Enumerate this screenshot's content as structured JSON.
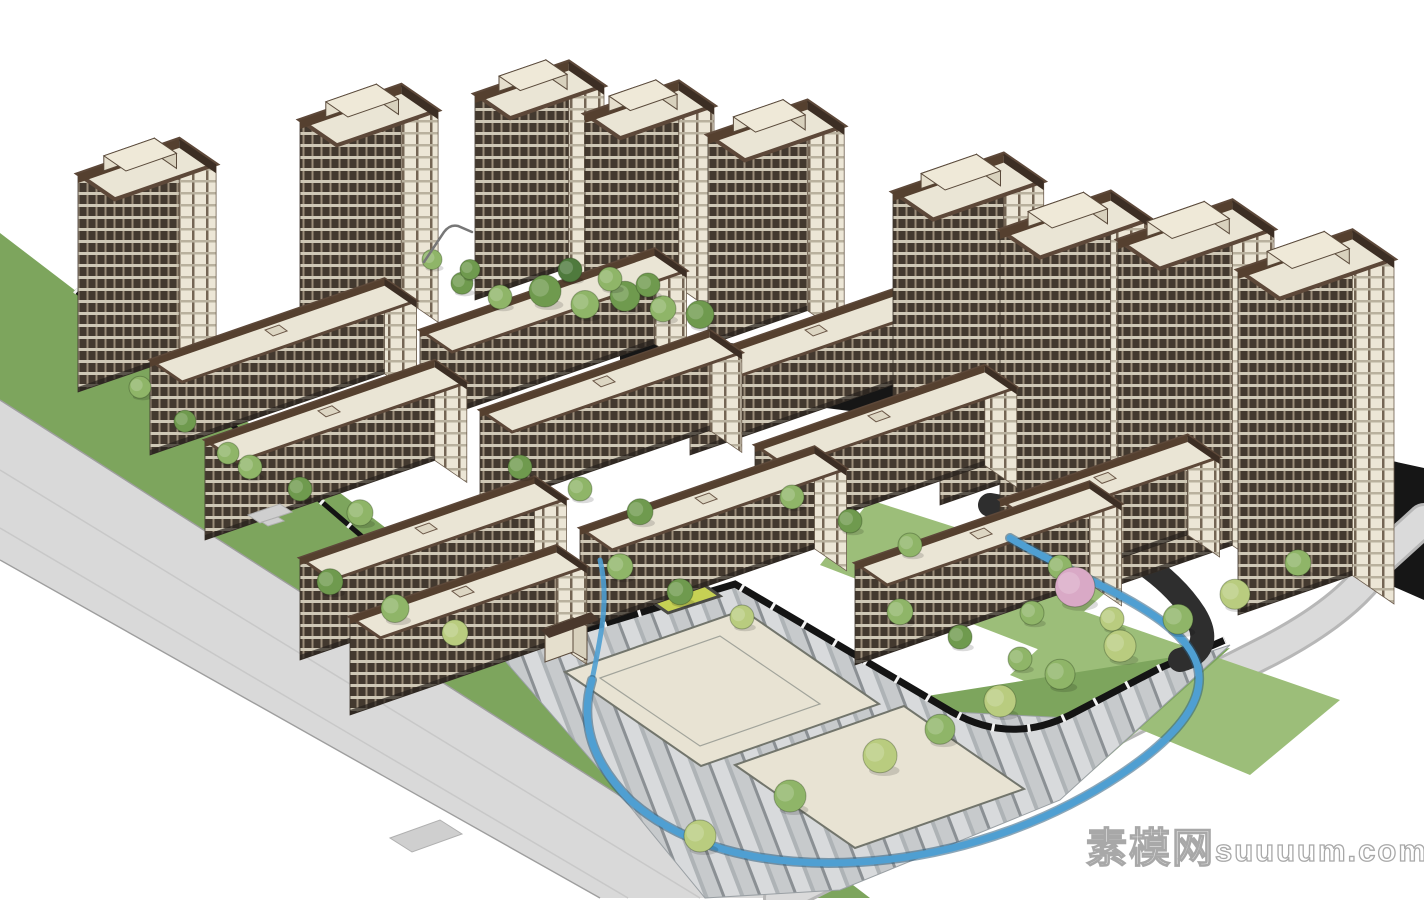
{
  "meta": {
    "image_type": "3d-architectural-massing-rendering",
    "subject": "residential-complex-site-aerial-view"
  },
  "watermark": {
    "cjk": "素模网",
    "latin": "suuuum.com"
  },
  "palette": {
    "bg": "#ffffff",
    "lawn": "#7da55d",
    "lawnLight": "#9cbe79",
    "gardenGreen": "#c6d154",
    "road": "#d9d9d9",
    "roadEdge": "#9e9e9e",
    "laneLine": "#c8c8c8",
    "sidewalk": "#dadada",
    "sidewalkEdge": "#b7b7b7",
    "asphalt": "#2e2e2e",
    "backRoad": "#161616",
    "paveA": "#c7cacc",
    "paveB": "#d8dadc",
    "paveDark": "#8b9094",
    "paveMid": "#aeb3b6",
    "pad": "#e8e3d3",
    "padLine": "#72756c",
    "padSmall": "#cfcfcf",
    "water": "#4f9fd2",
    "waterDark": "#2c5d7e",
    "fence": "#141414",
    "post": "#f2f2f2",
    "cream": "#eae5d5",
    "creamSide": "#ece6d6",
    "winDark": "#43392f",
    "winLight": "#9b8d7a",
    "band": "#cfc8b6",
    "sideLine": "#b9b19e",
    "sideWin": "#746554",
    "roofEdge": "#5d4839",
    "towerCap": "#55402f",
    "capSide": "#3c2e24",
    "roofBox": "#e5dfcd",
    "roofBoxSide": "#d8d1bd",
    "roofBoxTop": "#efe9d8",
    "base": "#26211c",
    "trunk": "#6b5a3f",
    "g1": "#6f9a4e",
    "g2": "#8fb568",
    "g3": "#b9cc7f",
    "g4": "#4f7a3d",
    "pink": "#d9a9c6",
    "lamp": "#777777",
    "wmFill": "#ffffff",
    "wmStroke": "#a8a8a8"
  },
  "scene": {
    "towers": [
      {
        "x": 78,
        "y": 392,
        "l": 108,
        "d": 46,
        "h": 218
      },
      {
        "x": 300,
        "y": 332,
        "l": 108,
        "d": 46,
        "h": 212
      },
      {
        "x": 475,
        "y": 300,
        "l": 100,
        "d": 44,
        "h": 206
      },
      {
        "x": 585,
        "y": 320,
        "l": 100,
        "d": 44,
        "h": 206
      },
      {
        "x": 708,
        "y": 345,
        "l": 106,
        "d": 46,
        "h": 210
      },
      {
        "x": 893,
        "y": 492,
        "l": 118,
        "d": 50,
        "h": 300
      },
      {
        "x": 1000,
        "y": 530,
        "l": 118,
        "d": 50,
        "h": 300
      },
      {
        "x": 1118,
        "y": 585,
        "l": 122,
        "d": 52,
        "h": 345
      },
      {
        "x": 1238,
        "y": 615,
        "l": 122,
        "d": 52,
        "h": 345
      }
    ],
    "slabs": [
      {
        "x": 150,
        "y": 455,
        "l": 250,
        "d": 40,
        "h": 95
      },
      {
        "x": 420,
        "y": 425,
        "l": 250,
        "d": 40,
        "h": 95
      },
      {
        "x": 690,
        "y": 455,
        "l": 250,
        "d": 40,
        "h": 95
      },
      {
        "x": 940,
        "y": 505,
        "l": 200,
        "d": 40,
        "h": 95
      },
      {
        "x": 205,
        "y": 540,
        "l": 245,
        "d": 40,
        "h": 100
      },
      {
        "x": 480,
        "y": 510,
        "l": 245,
        "d": 40,
        "h": 100
      },
      {
        "x": 755,
        "y": 545,
        "l": 245,
        "d": 40,
        "h": 100
      },
      {
        "x": 1000,
        "y": 600,
        "l": 200,
        "d": 40,
        "h": 100
      },
      {
        "x": 300,
        "y": 660,
        "l": 250,
        "d": 40,
        "h": 102
      },
      {
        "x": 580,
        "y": 630,
        "l": 250,
        "d": 40,
        "h": 102
      },
      {
        "x": 855,
        "y": 665,
        "l": 250,
        "d": 40,
        "h": 102
      },
      {
        "x": 350,
        "y": 715,
        "l": 220,
        "d": 38,
        "h": 98
      }
    ],
    "trees": [
      [
        545,
        295,
        16,
        "g1"
      ],
      [
        585,
        308,
        14,
        "g2"
      ],
      [
        625,
        300,
        15,
        "g1"
      ],
      [
        663,
        312,
        13,
        "g2"
      ],
      [
        700,
        318,
        14,
        "g1"
      ],
      [
        570,
        273,
        12,
        "g4"
      ],
      [
        610,
        282,
        12,
        "g2"
      ],
      [
        648,
        288,
        12,
        "g1"
      ],
      [
        500,
        300,
        12,
        "g2"
      ],
      [
        462,
        286,
        11,
        "g1"
      ],
      [
        432,
        262,
        10,
        "g2"
      ],
      [
        470,
        272,
        10,
        "g1"
      ],
      [
        250,
        470,
        12,
        "g2"
      ],
      [
        300,
        492,
        12,
        "g1"
      ],
      [
        360,
        516,
        13,
        "g2"
      ],
      [
        520,
        470,
        12,
        "g1"
      ],
      [
        580,
        492,
        12,
        "g2"
      ],
      [
        640,
        515,
        13,
        "g1"
      ],
      [
        792,
        500,
        12,
        "g2"
      ],
      [
        850,
        524,
        12,
        "g1"
      ],
      [
        910,
        548,
        12,
        "g2"
      ],
      [
        1060,
        570,
        12,
        "g2"
      ],
      [
        330,
        585,
        13,
        "g1"
      ],
      [
        395,
        612,
        14,
        "g2"
      ],
      [
        455,
        636,
        13,
        "g3"
      ],
      [
        620,
        570,
        13,
        "g2"
      ],
      [
        680,
        595,
        13,
        "g1"
      ],
      [
        742,
        620,
        12,
        "g3"
      ],
      [
        900,
        615,
        13,
        "g2"
      ],
      [
        960,
        640,
        12,
        "g1"
      ],
      [
        1020,
        662,
        12,
        "g2"
      ],
      [
        1075,
        592,
        20,
        "pink"
      ],
      [
        1032,
        616,
        12,
        "g2"
      ],
      [
        1112,
        622,
        12,
        "g3"
      ],
      [
        700,
        840,
        16,
        "g3"
      ],
      [
        790,
        800,
        16,
        "g2"
      ],
      [
        880,
        760,
        17,
        "g3"
      ],
      [
        940,
        733,
        15,
        "g2"
      ],
      [
        1000,
        705,
        16,
        "g3"
      ],
      [
        1060,
        678,
        15,
        "g2"
      ],
      [
        1120,
        650,
        16,
        "g3"
      ],
      [
        1178,
        623,
        15,
        "g2"
      ],
      [
        1235,
        598,
        15,
        "g3"
      ],
      [
        1298,
        566,
        13,
        "g2"
      ],
      [
        140,
        390,
        11,
        "g2"
      ],
      [
        185,
        424,
        11,
        "g1"
      ],
      [
        228,
        456,
        11,
        "g2"
      ]
    ],
    "lamp": {
      "x": 424,
      "y": 262
    }
  }
}
